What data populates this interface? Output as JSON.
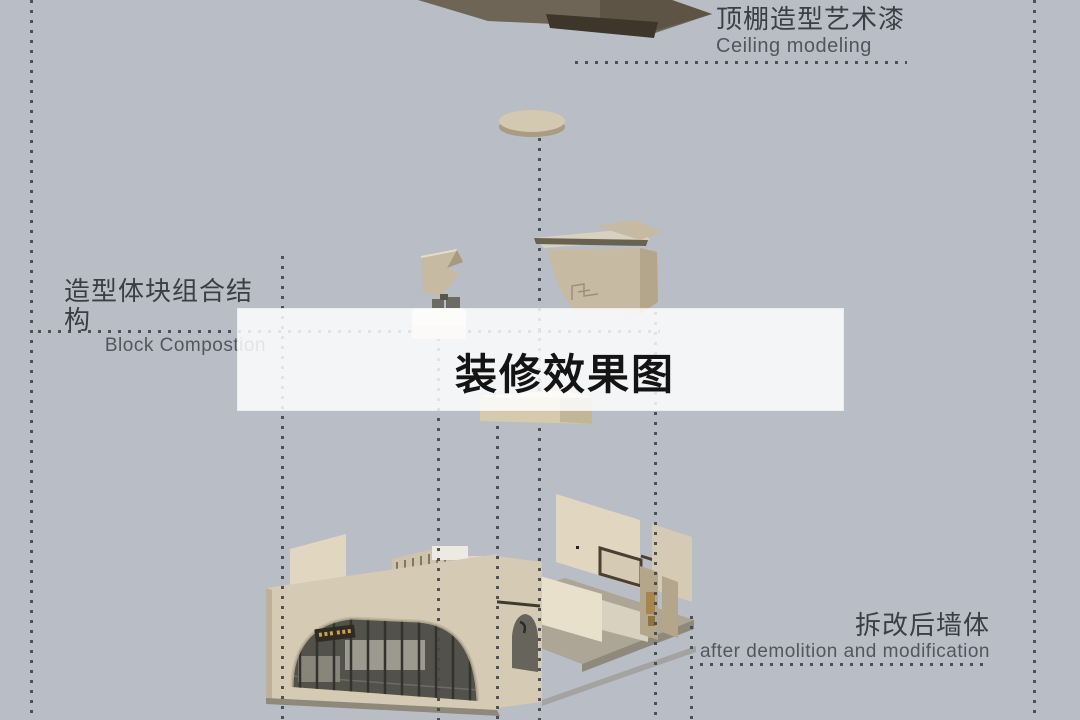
{
  "title": {
    "text": "装修效果图"
  },
  "callouts": {
    "ceiling": {
      "zh": "顶棚造型艺术漆",
      "en": "Ceiling modeling"
    },
    "block": {
      "zh": "造型体块组合结构",
      "en": "Block Compostion"
    },
    "wall": {
      "zh": "拆改后墙体",
      "en": "after demolition and modification"
    }
  },
  "figure": {
    "objects": [
      {
        "id": "ceiling-panel",
        "desc": "dark ceiling slab with recessed modeling panel"
      },
      {
        "id": "ceiling-disc",
        "desc": "round ceiling canopy disc"
      },
      {
        "id": "block-pieces",
        "desc": "small beige composition blocks"
      },
      {
        "id": "reception-volume",
        "desc": "curved beige counter volume with flat canopy"
      },
      {
        "id": "shelf-block",
        "desc": "low beige block"
      },
      {
        "id": "room-shell",
        "desc": "room shell with arched storefront, demolished walls and floor"
      }
    ]
  },
  "colors": {
    "bg": "#b9bdc6",
    "band": "rgba(255,255,255,0.84)",
    "ink": "#3b3e44",
    "inkSoft": "#53565c",
    "titleInk": "#141414",
    "dot": "#45474d",
    "slab": "#6e6556",
    "slabDark": "#3e362b",
    "cream": "#d3c9b0",
    "creamShade": "#a99c80",
    "beige": "#c6baa2",
    "beigeLight": "#d8d1bf",
    "beigeLighter": "#eae3d1",
    "wall": "#d5cab3",
    "wallLight": "#e1d7c1",
    "wallLighter": "#e9e0cc",
    "wallShade": "#b3a68b",
    "glass": "#52524b",
    "mullion": "#33332e",
    "floor": "#ada595",
    "shadow": "#8f897c",
    "whiteBox": "#edeae1",
    "frame": "#4a3f30",
    "sign": "#2f2a22",
    "gold": "#cfa14f"
  }
}
